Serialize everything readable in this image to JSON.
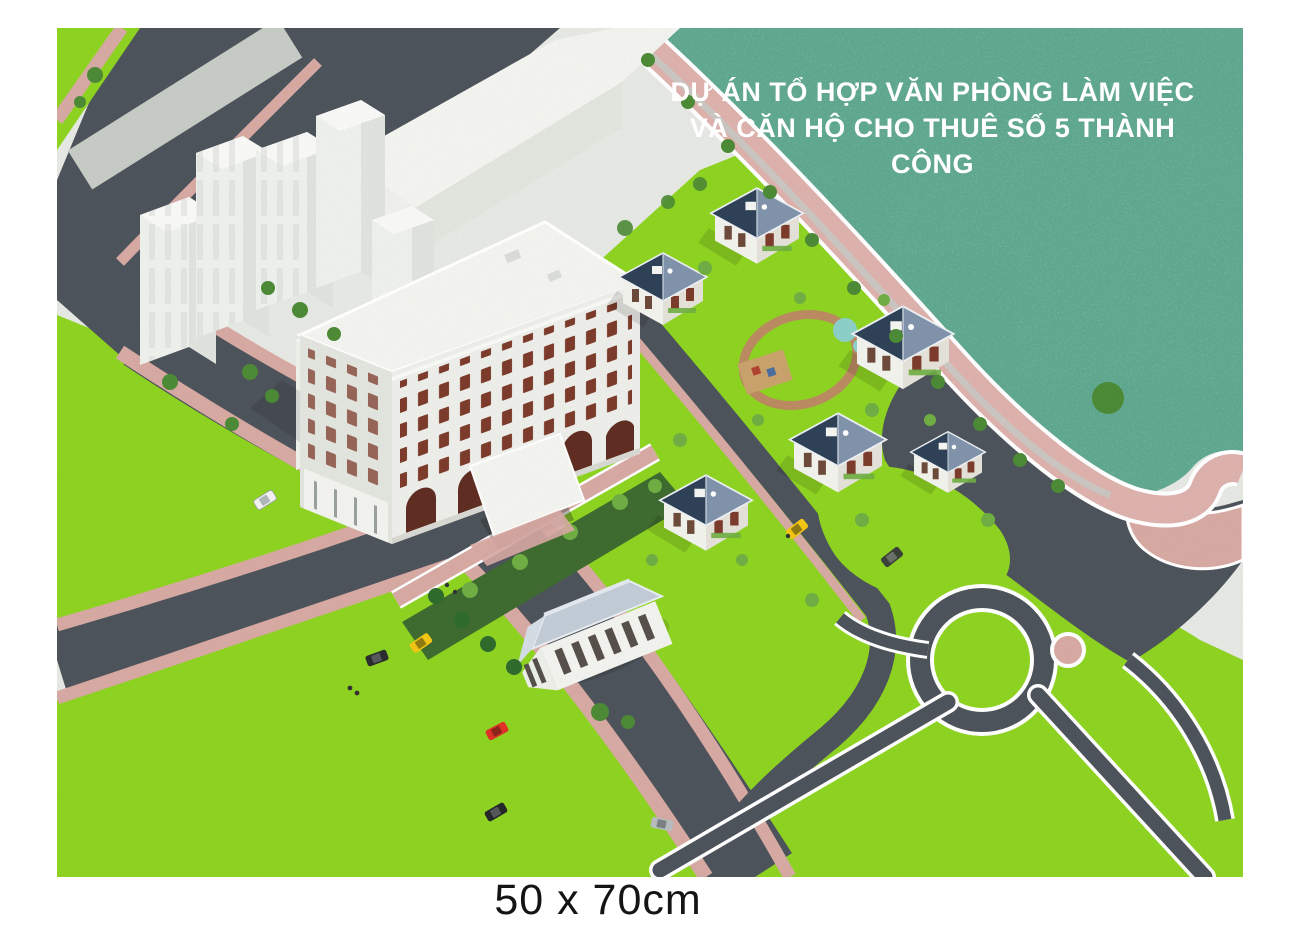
{
  "artwork": {
    "title": {
      "line1": "DỰ ÁN TỔ HỢP VĂN PHÒNG LÀM VIỆC",
      "line2": "VÀ CĂN HỘ CHO THUÊ SỐ 5 THÀNH CÔNG"
    },
    "caption": "50 x 70cm",
    "colors": {
      "page": "#ffffff",
      "ground": "#e6e8e4",
      "water": "#5ea88e",
      "lawn": "#8ed321",
      "road": "#4d535a",
      "sidewalk": "#d7a9a3",
      "promenade": "#ddb1ac",
      "concrete": "#c6cbc5",
      "building": "#f3f4ef",
      "building_shade": "#e2e4de",
      "window": "#7c3b2b",
      "villa_roof": "#2e4156",
      "villa_roof_light": "#8093aa",
      "clubhouse_roof": "#c2ccd6",
      "tree": "#4c8a36",
      "shrub": "#6fae43",
      "hedge": "#3e6b2f",
      "taxi": "#f2c514",
      "car_red": "#e03127",
      "title_text": "#ffffff",
      "caption_text": "#141414"
    }
  }
}
